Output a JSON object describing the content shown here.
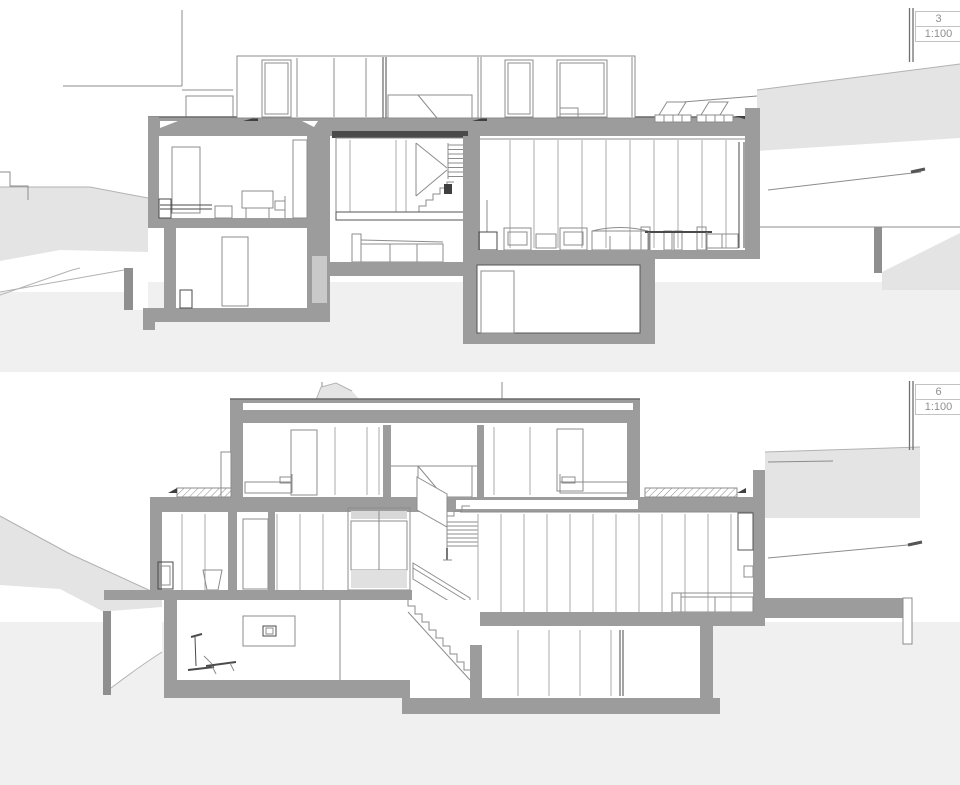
{
  "document": {
    "type": "architectural-section-sheet",
    "background": "#ffffff"
  },
  "colors": {
    "cut_wall_poche": "#9c9c9c",
    "retaining_post": "#8f8f8f",
    "terrain_fill": "#e4e4e4",
    "ground_wash": "#f0f0f0",
    "line_mid": "#8c8c8c",
    "line_dark": "#4a4a4a",
    "glass_tint": "#d8d8d8",
    "label_text": "#8f8f8f",
    "label_border": "#c3c3c3"
  },
  "drawings": [
    {
      "name": "section-3",
      "number": "3",
      "scale": "1:100"
    },
    {
      "name": "section-6",
      "number": "6",
      "scale": "1:100"
    }
  ]
}
